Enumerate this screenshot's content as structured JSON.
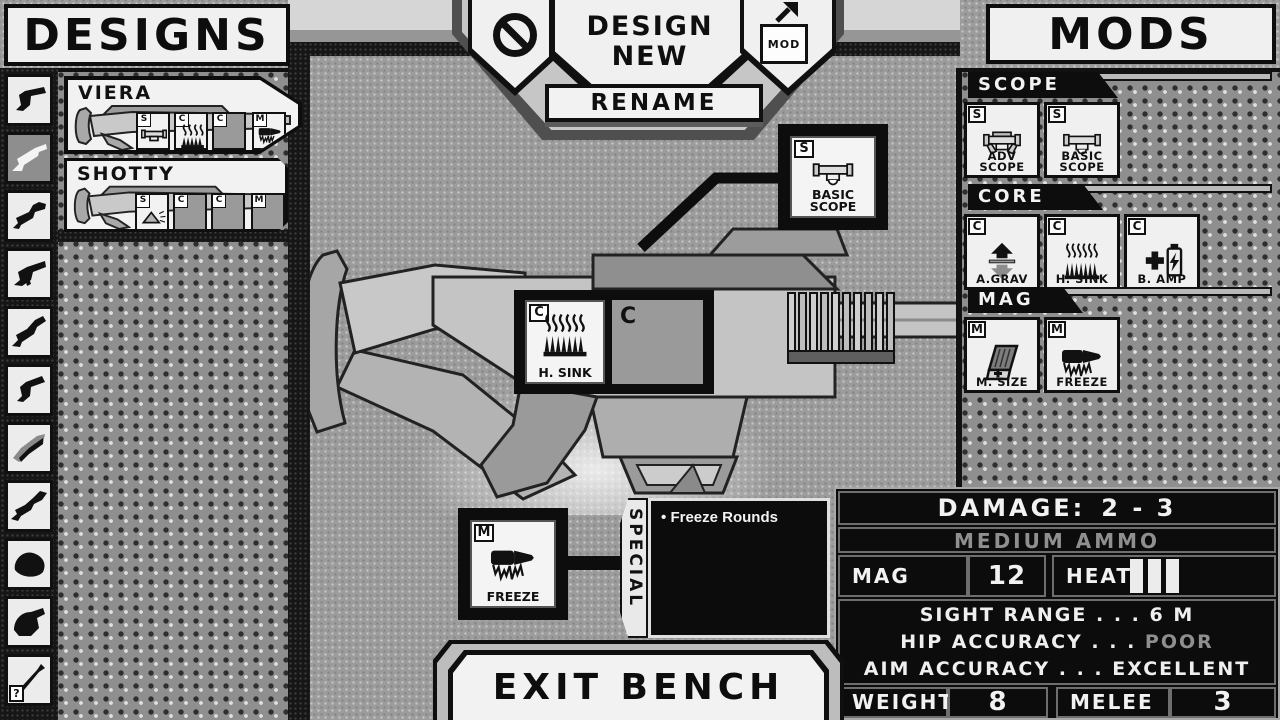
{
  "theme": {
    "ink": "#111111",
    "paper": "#f0f0f0",
    "muted_text": "#8f8f8f",
    "mid_gray": "#9c9c9c"
  },
  "designs_panel": {
    "title": "DESIGNS",
    "weapon_categories": [
      "pistol",
      "shotgun",
      "rifle",
      "smg",
      "carbine",
      "sidearm",
      "launcher",
      "sniper",
      "heavy",
      "machine-gun",
      "spear"
    ],
    "help_label": "?",
    "designs": [
      {
        "name": "VIERA",
        "selected": true,
        "slots": [
          {
            "badge": "S",
            "mod": "basic-scope",
            "filled": true
          },
          {
            "badge": "C",
            "mod": "heat-sink",
            "filled": true
          },
          {
            "badge": "C",
            "mod": "",
            "filled": false
          },
          {
            "badge": "M",
            "mod": "freeze",
            "filled": true
          }
        ]
      },
      {
        "name": "SHOTTY",
        "selected": false,
        "slots": [
          {
            "badge": "S",
            "mod": "spread",
            "filled": true
          },
          {
            "badge": "C",
            "mod": "",
            "filled": false
          },
          {
            "badge": "C",
            "mod": "",
            "filled": false
          },
          {
            "badge": "M",
            "mod": "",
            "filled": false
          }
        ]
      }
    ]
  },
  "toolbar": {
    "delete_icon": "no-symbol",
    "design_new_label": "DESIGN NEW",
    "rename_label": "RENAME",
    "export_mod_label": "MOD"
  },
  "mods_panel": {
    "title": "MODS",
    "sections": [
      {
        "name": "SCOPE",
        "mods": [
          {
            "badge": "S",
            "label": "ADV\nSCOPE",
            "icon": "adv-scope"
          },
          {
            "badge": "S",
            "label": "BASIC\nSCOPE",
            "icon": "basic-scope"
          }
        ]
      },
      {
        "name": "CORE",
        "mods": [
          {
            "badge": "C",
            "label": "A.GRAV",
            "icon": "anti-grav"
          },
          {
            "badge": "C",
            "label": "H. SINK",
            "icon": "heat-sink"
          },
          {
            "badge": "C",
            "label": "B. AMP",
            "icon": "battery-amp"
          }
        ]
      },
      {
        "name": "MAG",
        "mods": [
          {
            "badge": "M",
            "label": "M. SIZE",
            "icon": "mag-size"
          },
          {
            "badge": "M",
            "label": "FREEZE",
            "icon": "freeze"
          }
        ]
      }
    ]
  },
  "bench": {
    "equipped_scope": {
      "badge": "S",
      "label": "BASIC\nSCOPE",
      "icon": "basic-scope"
    },
    "equipped_core": {
      "badge": "C",
      "label": "H. SINK",
      "icon": "heat-sink"
    },
    "empty_core_badge": "C",
    "equipped_mag": {
      "badge": "M",
      "label": "FREEZE",
      "icon": "freeze"
    },
    "special": {
      "title": "SPECIAL",
      "bullet": "•",
      "items": [
        "Freeze Rounds"
      ]
    }
  },
  "stats": {
    "damage_label": "DAMAGE:",
    "damage_value": "2 - 3",
    "ammo_type": "MEDIUM AMMO",
    "mag_size_label": "MAG SIZE",
    "mag_size_value": "12",
    "heat_label": "HEAT",
    "heat_bars": 3,
    "dots_separator": " . . . ",
    "details": [
      {
        "label": "SIGHT RANGE",
        "value": "6 M"
      },
      {
        "label": "HIP ACCURACY",
        "value": "POOR"
      },
      {
        "label": "AIM ACCURACY",
        "value": "EXCELLENT"
      }
    ],
    "weight_label": "WEIGHT",
    "weight_value": "8",
    "melee_label": "MELEE",
    "melee_value": "3"
  },
  "exit_label": "EXIT BENCH"
}
